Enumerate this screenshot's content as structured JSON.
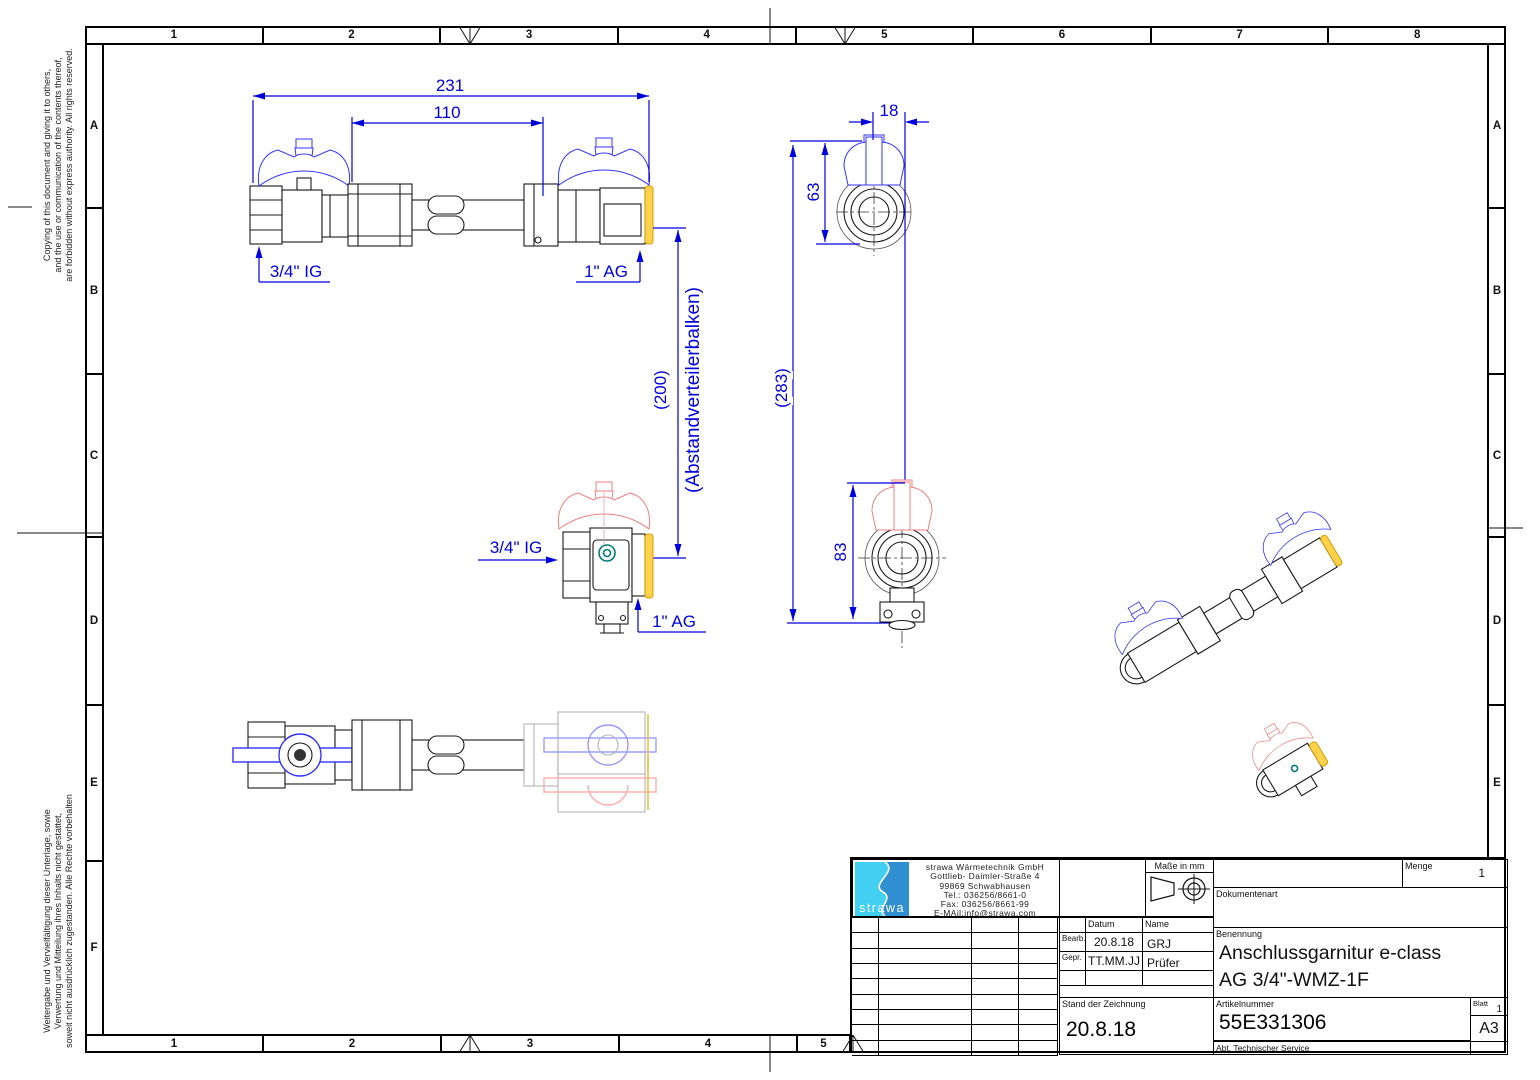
{
  "frame": {
    "columns": [
      "1",
      "2",
      "3",
      "4",
      "5",
      "6",
      "7",
      "8"
    ],
    "rows": [
      "A",
      "B",
      "C",
      "D",
      "E",
      "F"
    ],
    "bottom_columns": [
      "1",
      "2",
      "3",
      "4",
      "5"
    ],
    "copyright_top_lines": [
      "Copying of this document and giving it to others,",
      "and the use or communication of the contents thereof,",
      "are forbidden without express authority. All rights reserved."
    ],
    "copyright_bottom_lines": [
      "Weitergabe und Vervielfältigung dieser Unterlage, sowie",
      "Verwertung und Mitteilung ihres Inhalts nicht gestattet,",
      "soweit nicht ausdrücklich zugestanden. Alle Rechte vorbehalten"
    ]
  },
  "title_block": {
    "logo_text": "strawa",
    "company": [
      "strawa Wärmetechnik GmbH",
      "Gottlieb- Daimler-Straße 4",
      "99869 Schwabhausen",
      "Tel.: 036256/8661-0",
      "Fax: 036256/8661-99",
      "E-MAil:info@strawa.com"
    ],
    "masse_label": "Maße in mm",
    "menge_label": "Menge",
    "menge_value": "1",
    "dokumentenart_label": "Dokumentenart",
    "datum_label": "Datum",
    "name_label": "Name",
    "bearb_label": "Bearb.",
    "bearb_datum": "20.8.18",
    "bearb_name": "GRJ",
    "gepr_label": "Gepr.",
    "gepr_datum": "TT.MM.JJ",
    "gepr_name": "Prüfer",
    "benennung_label": "Benennung",
    "benennung_line1": "Anschlussgarnitur e-class",
    "benennung_line2": "AG 3/4\"-WMZ-1F",
    "stand_label": "Stand der Zeichnung",
    "stand_value": "20.8.18",
    "artikel_label": "Artikelnummer",
    "artikel_value": "55E331306",
    "blatt_label": "Blatt",
    "blatt_value": "1",
    "format": "A3",
    "abt_label": "Abt. Technischer Service"
  },
  "dimensions": {
    "overall_length": "231",
    "pipe_length": "110",
    "offset_18": "18",
    "height_63": "63",
    "height_83": "83",
    "spacing_200": "(200)",
    "spacing_note": "(Abstandverteilerbalken)",
    "overall_height_283": "(283)"
  },
  "labels": {
    "ig_front": "3/4\" IG",
    "ag_front": "1\" AG",
    "ig_side": "3/4\" IG",
    "ag_side": "1\" AG"
  },
  "colors": {
    "dimension_blue": "#0000dd",
    "handle_blue": "#3333ff",
    "handle_red": "#ef8080",
    "cap_yellow": "#ffd24d",
    "seal_teal": "#007d78",
    "logo_cyan": "#41d0f2",
    "logo_blue": "#2f8fd0"
  }
}
